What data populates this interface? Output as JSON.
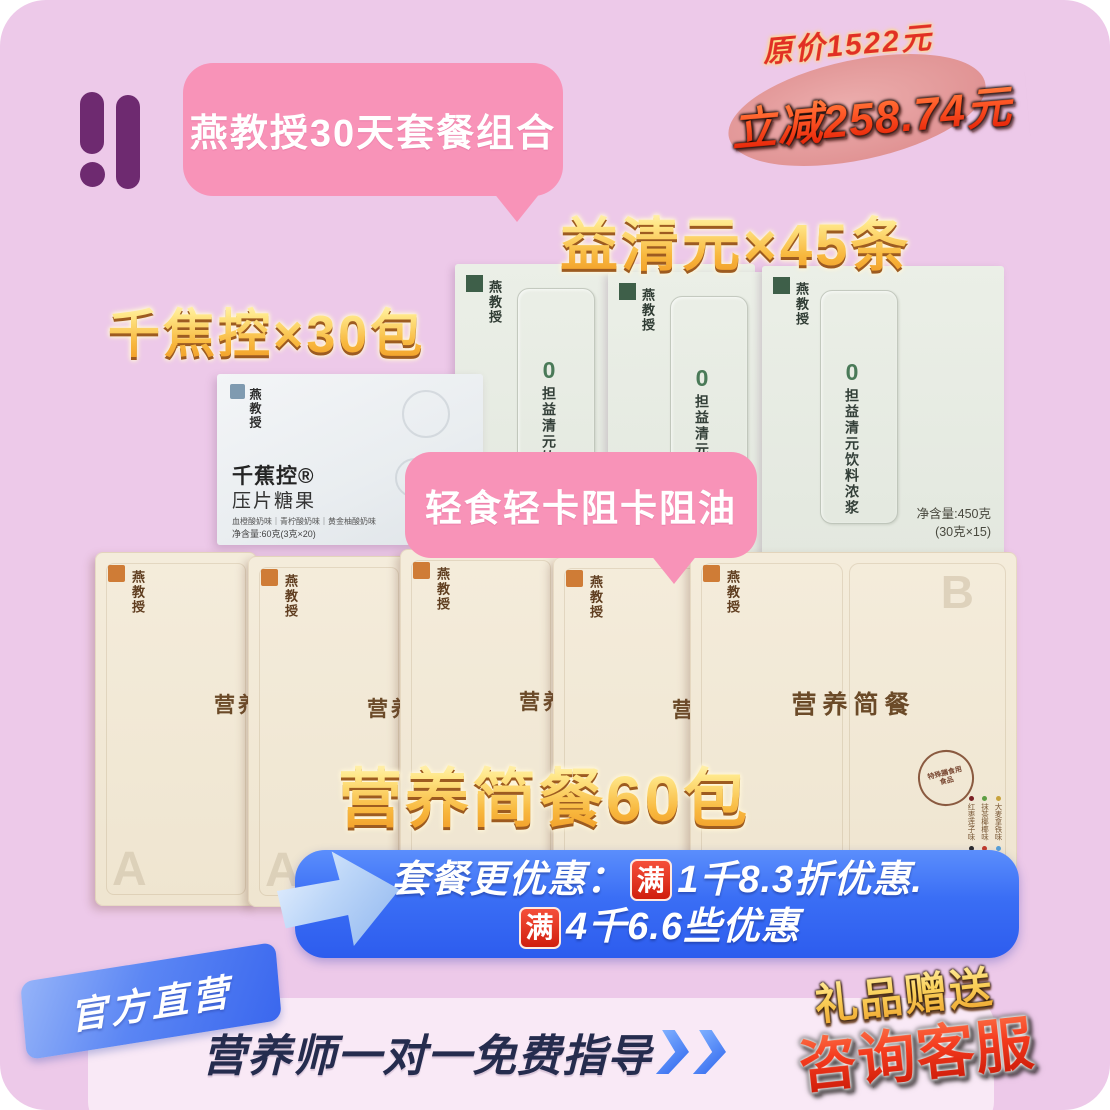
{
  "header": {
    "combo_bubble": "燕教授30天套餐组合",
    "original_price": "原价1522元",
    "discount": "立减258.74元"
  },
  "headlines": {
    "yiqingyuan": "益清元×45条",
    "qianjiaokong": "千焦控×30包",
    "meal": "营养简餐60包"
  },
  "feature_bubble": "轻食轻卡阻卡阻油",
  "white_box": {
    "brand": "燕教授",
    "product_name": "千蕉控®",
    "product_type": "压片糖果",
    "flavors": "血橙酸奶味｜青柠酸奶味｜黄金柚酸奶味",
    "net_weight": "净含量:60克(3克×20)"
  },
  "green_package": {
    "brand": "燕教授",
    "zero": "0",
    "product_name": "担益清元饮料浓浆",
    "net_weight_line1": "净含量:450克",
    "net_weight_line2": "(30克×15)"
  },
  "cream_package": {
    "brand": "燕教授",
    "partial_name": "营养",
    "product_name": "营养简餐",
    "letter_a": "A",
    "letter_b": "B",
    "stamp_ring": "FOOD FOR SPECIAL DIETARY USES",
    "stamp_line1": "特殊膳食用",
    "stamp_line2": "食品",
    "flavors": [
      {
        "label": "大麦拿铁味",
        "dot": "#c8a23c"
      },
      {
        "label": "抹茶椰椰味",
        "dot": "#5e9e44"
      },
      {
        "label": "红枣莲子味",
        "dot": "#7a2024"
      },
      {
        "label": "海盐豆乳味",
        "dot": "#58a0d8"
      },
      {
        "label": "陈皮红豆味",
        "dot": "#c23a28"
      },
      {
        "label": "芝麻黑豆味",
        "dot": "#2a2a2a"
      }
    ]
  },
  "banner": {
    "line1_prefix": "套餐更优惠：",
    "full_badge": "满",
    "line1_rest": "1千8.3折优惠.",
    "line2_rest": "4千6.6些优惠"
  },
  "footer": {
    "official": "官方直营",
    "coach": "营养师一对一免费指导",
    "gift": "礼品赠送",
    "contact": "咨询客服"
  },
  "colors": {
    "background": "#edc9e9",
    "logo_purple": "#6e2a70",
    "bubble_pink": "#f893b8",
    "banner_blue": "#2f66ee",
    "gold_top": "#fffbe2",
    "gold_bottom": "#ef9420",
    "price_red": "#e13024",
    "contact_red": "#c41404",
    "navy_text": "#252c4e",
    "green_package": "#e8ece4",
    "cream_package": "#f3ead8"
  }
}
